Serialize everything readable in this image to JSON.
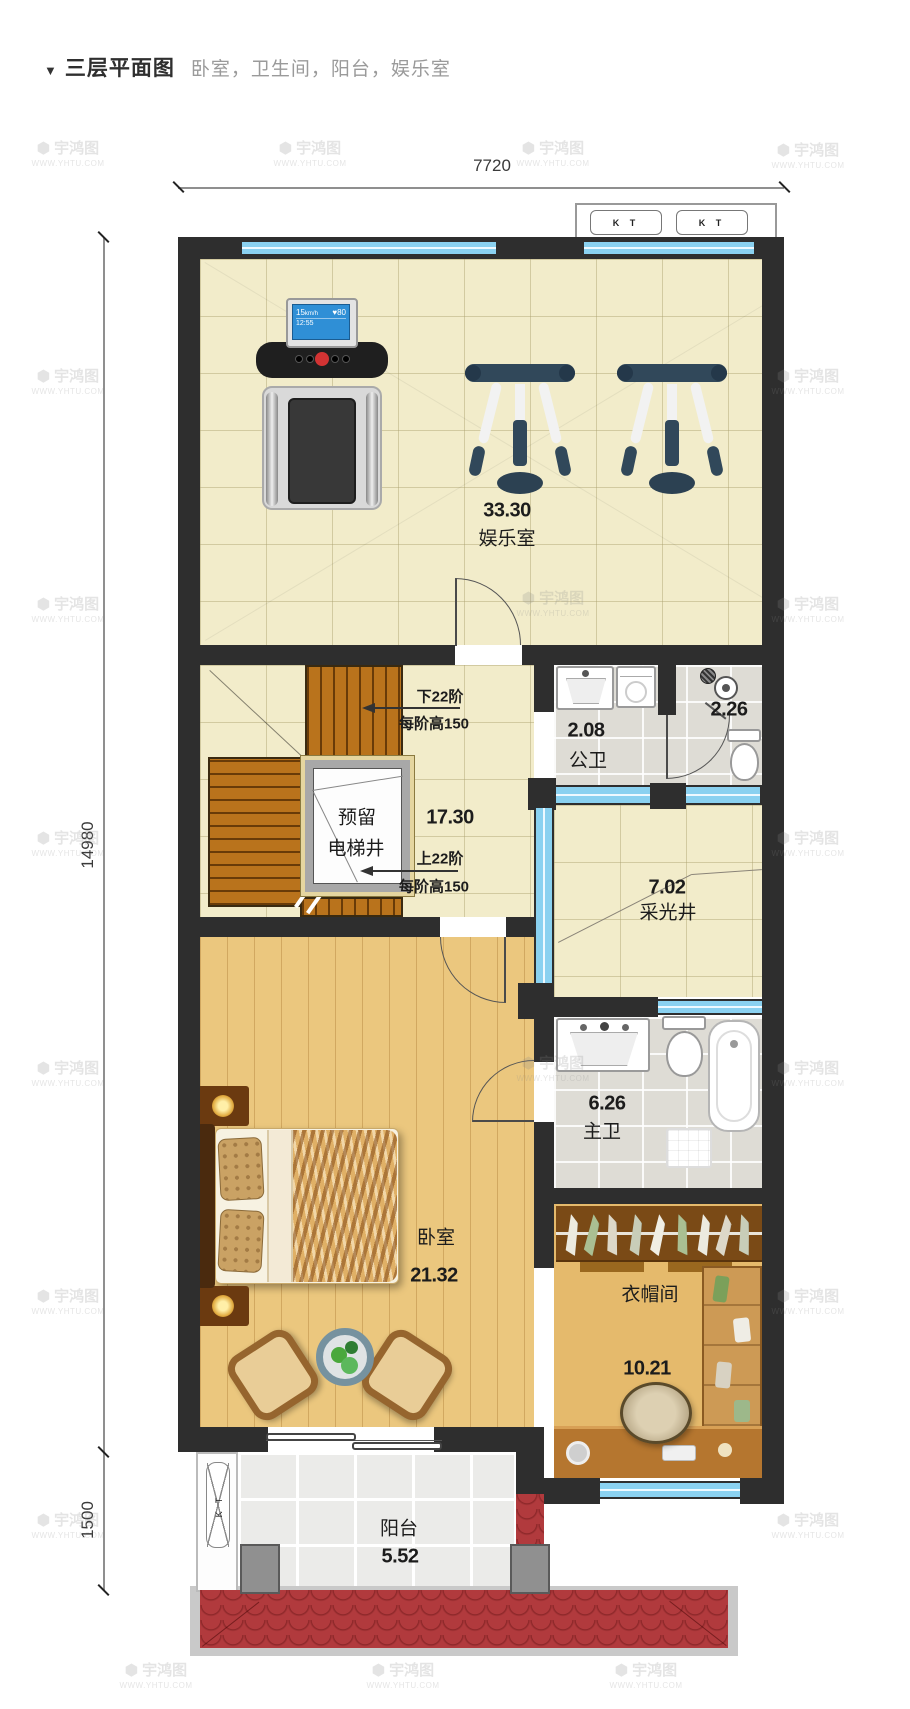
{
  "header": {
    "marker": "▼",
    "title": "三层平面图",
    "subtitle": "卧室，卫生间，阳台，娱乐室"
  },
  "watermark": {
    "logo": "⬢",
    "brand": "宇鸿图",
    "url": "WWW.YHTU.COM"
  },
  "dimensions": {
    "width_top": "7720",
    "height_main": "14980",
    "height_balcony": "1500"
  },
  "hvac": {
    "ac_label": "K T"
  },
  "treadmill_display": {
    "speed": "15",
    "unit": "km/h",
    "heart": "♥80",
    "time": "12:55"
  },
  "rooms": {
    "entertainment": {
      "area": "33.30",
      "name": "娱乐室"
    },
    "stair_hall": {
      "area": "17.30"
    },
    "elevator_shaft": {
      "line1": "预留",
      "line2": "电梯井"
    },
    "stairs_down": {
      "steps": "下22阶",
      "rise": "每阶高150"
    },
    "stairs_up": {
      "steps": "上22阶",
      "rise": "每阶高150"
    },
    "public_bathroom": {
      "area": "2.08",
      "name": "公卫"
    },
    "shower_room": {
      "area": "2.26"
    },
    "light_well": {
      "area": "7.02",
      "name": "采光井"
    },
    "master_bathroom": {
      "area": "6.26",
      "name": "主卫"
    },
    "bedroom": {
      "name": "卧室",
      "area": "21.32"
    },
    "cloakroom": {
      "name": "衣帽间",
      "area": "10.21"
    },
    "balcony": {
      "name": "阳台",
      "area": "5.52"
    }
  },
  "colors": {
    "wall": "#2e2e2e",
    "window_glass": "#8ad1f0",
    "stair_wood": "#b9731c",
    "roof_tile_red": "#b13a3d",
    "floor_tile_cream": "#f2ecca",
    "floor_wood": "#ebc77e",
    "bath_tile_grey": "#dedcd5",
    "equipment_navy": "#31485a"
  }
}
